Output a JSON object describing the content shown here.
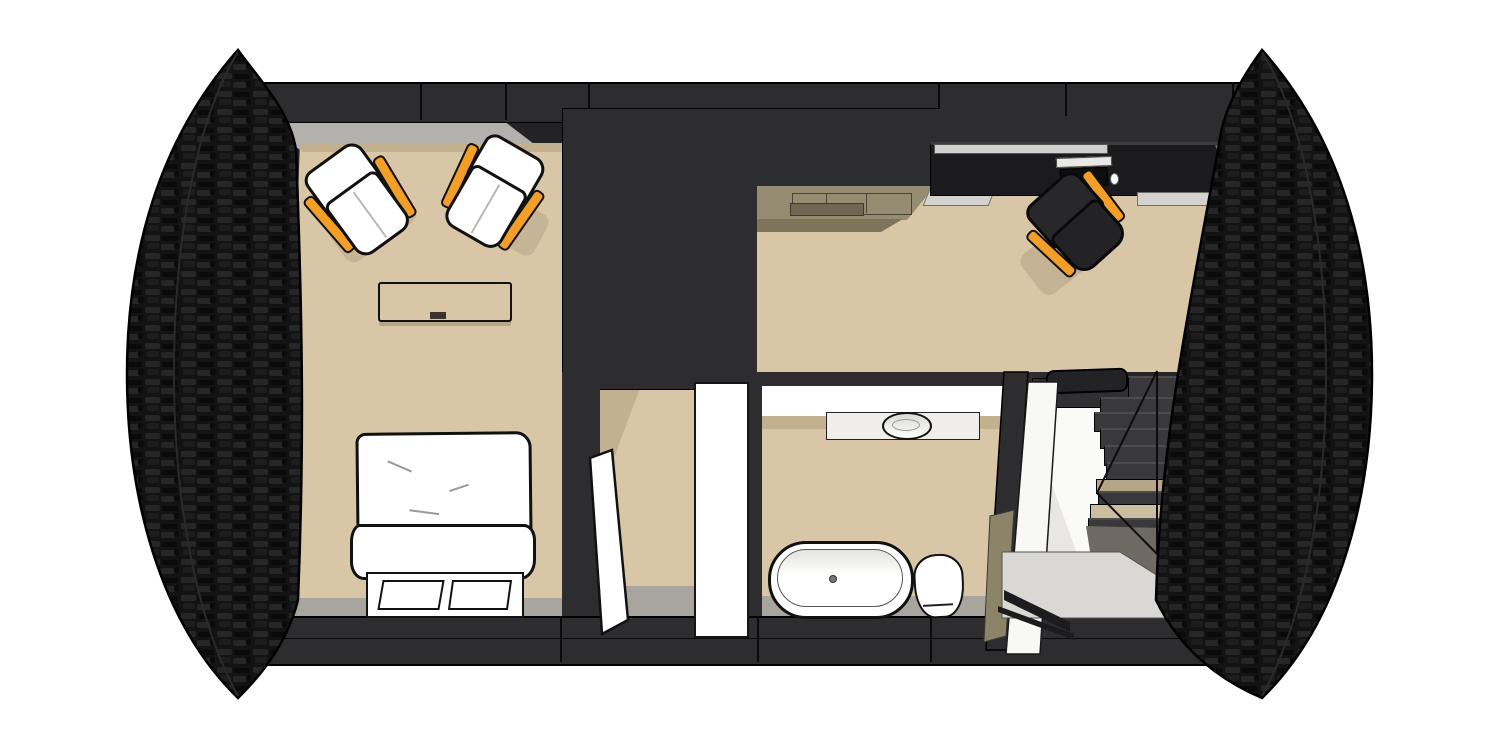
{
  "scene": {
    "title": "3D cutaway floor plan, top view",
    "render_style": "architectural sketch render, white background",
    "building": {
      "end_walls": "curved black dry-stone gable walls (left and right)",
      "section_walls": "dark charcoal cut walls along top and bottom"
    },
    "rooms": [
      {
        "id": "bedroom",
        "label": "bedroom",
        "floor": "tan",
        "furniture": [
          {
            "name": "lounge-chair",
            "color": "white",
            "accent": "orange rails",
            "count": 2
          },
          {
            "name": "bench-low-table",
            "color": "tan",
            "count": 1
          },
          {
            "name": "double-bed",
            "parts": [
              "duvet",
              "folded-blanket",
              "foot-bench",
              "pillow",
              "pillow"
            ],
            "color": "white",
            "count": 1
          }
        ]
      },
      {
        "id": "hallway",
        "label": "hallway",
        "floor": "tan",
        "furniture": [
          {
            "name": "door-open-leaf",
            "color": "white",
            "count": 1
          },
          {
            "name": "door-panel",
            "color": "white",
            "count": 1
          }
        ]
      },
      {
        "id": "bathroom",
        "label": "bathroom",
        "floor": "tan",
        "furniture": [
          {
            "name": "vanity-counter",
            "color": "white",
            "count": 1
          },
          {
            "name": "round-basin",
            "color": "white",
            "count": 1
          },
          {
            "name": "freestanding-bathtub",
            "color": "white",
            "count": 1
          },
          {
            "name": "toilet",
            "color": "white",
            "count": 1
          }
        ]
      },
      {
        "id": "living-kitchen",
        "label": "living / kitchen area",
        "floor": "tan",
        "furniture": [
          {
            "name": "kitchen-counter",
            "color": "khaki",
            "count": 1
          },
          {
            "name": "desk-sideboard",
            "color": "near-black",
            "count": 1
          },
          {
            "name": "laptop",
            "color": "black",
            "count": 1
          },
          {
            "name": "mouse",
            "color": "white",
            "count": 1
          },
          {
            "name": "office-chair",
            "color": "dark gray",
            "accent": "orange rails",
            "count": 1
          }
        ]
      },
      {
        "id": "stair-hall",
        "label": "staircase hall",
        "floor": "white / light gray landing",
        "furniture": [
          {
            "name": "staircase",
            "treads": 10,
            "tread_colors": [
              "dark gray",
              "tan landings"
            ],
            "count": 1
          },
          {
            "name": "glass-railing-lines",
            "count": 1
          },
          {
            "name": "bottom-handrail",
            "color": "black",
            "count": 1
          },
          {
            "name": "stair-shelf",
            "color": "dark",
            "count": 1
          }
        ]
      }
    ],
    "core": {
      "name": "central-wardrobe-core",
      "color": "dark charcoal"
    }
  },
  "colors": {
    "background": "#ffffff",
    "stone_base": "#131313",
    "stone_light": "#262626",
    "stone_mid": "#1d1d1d",
    "stone_dark": "#0a0a0a",
    "wall_dark": "#2d2d2f",
    "wall_darker": "#232325",
    "outline": "#000000",
    "floor_tan": "#d8c6a6",
    "floor_tan_shadow": "#c2b08e",
    "floor_gray": "#a8a49e",
    "wall_gray_face": "#b3b1ad",
    "counter_khaki": "#968c72",
    "counter_khaki_shadow": "#7d7459",
    "desk_black": "#1b1b1d",
    "edge_light_gray": "#d3d2cf",
    "white": "#ffffff",
    "off_white": "#f8f8f6",
    "accent_orange": "#f29e27",
    "tread_dark": "#39393b",
    "tread_tan": "#b5a687",
    "tread_tan_light": "#cbbd9f",
    "landing_gray": "#d9d8d5",
    "shadow_gray": "#6e6a62",
    "stair_hall_white": "#fafaf8",
    "khaki_wedge": "#8c8468"
  }
}
